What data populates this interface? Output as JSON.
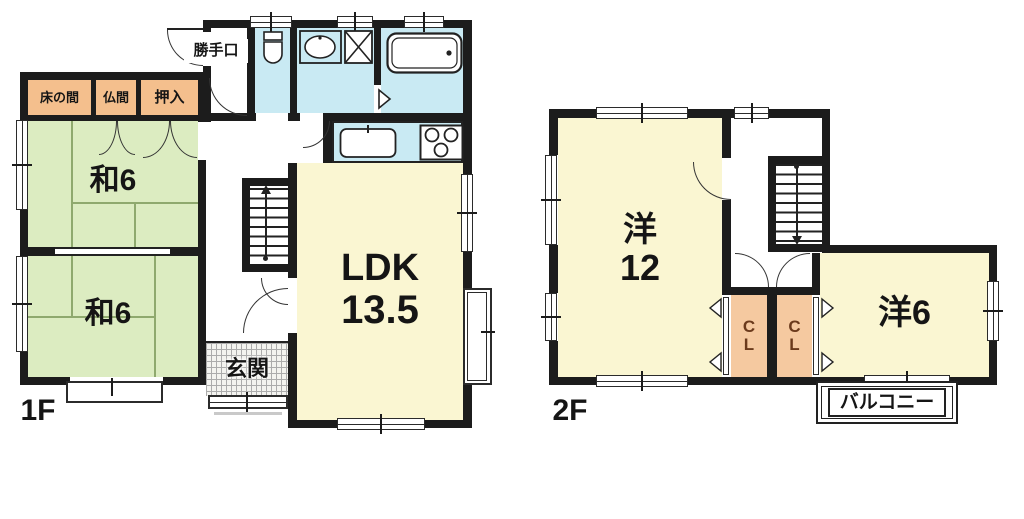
{
  "floor1": {
    "label": "1F",
    "tokonoma": "床の間",
    "butsuma": "仏間",
    "oshiire": "押入",
    "washitsu_upper": "和6",
    "washitsu_lower": "和6",
    "ldk_line1": "LDK",
    "ldk_line2": "13.5",
    "genkan": "玄関",
    "katteguchi": "勝手口"
  },
  "floor2": {
    "label": "2F",
    "yoshitsu12_kanji": "洋",
    "yoshitsu12_num": "12",
    "yoshitsu6": "洋6",
    "closet1_c": "C",
    "closet1_l": "L",
    "closet2_c": "C",
    "closet2_l": "L",
    "balcony": "バルコニー"
  },
  "colors": {
    "wall": "#1c1c1c",
    "tatami": "#dcecc1",
    "tatami_line": "#8fa96e",
    "room_yellow": "#faf6d2",
    "water_blue": "#c9eaf3",
    "alcove_orange": "#f4bf8d",
    "closet_orange": "#f5c9a0",
    "closet_text": "#6b3a1c"
  }
}
